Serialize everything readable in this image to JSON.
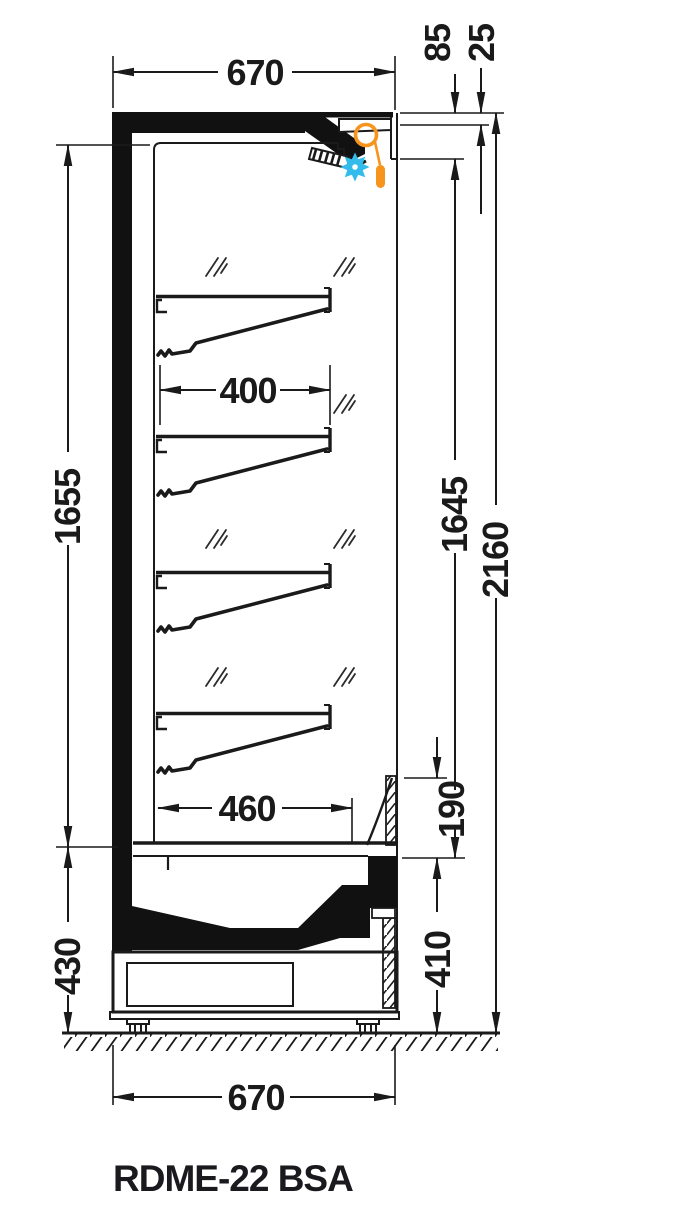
{
  "title": "RDME-22 BSA",
  "dims": {
    "top_width": "670",
    "canopy_depth": "85",
    "canopy_front": "25",
    "interior_height_left": "1655",
    "shelf_width": "400",
    "opening_height": "1645",
    "total_height": "2160",
    "bottom_shelf_width": "460",
    "deflector_height": "190",
    "base_front_height": "410",
    "base_rear_height": "430",
    "bottom_width": "670"
  },
  "icons": {
    "night_blind": "night-blind-roll",
    "cold_air": "snowflake-burst"
  },
  "colors": {
    "line": "#1a1a1a",
    "night_blind_orange": "#F7941E",
    "cold_air_blue": "#33BBEC",
    "background": "#ffffff"
  }
}
